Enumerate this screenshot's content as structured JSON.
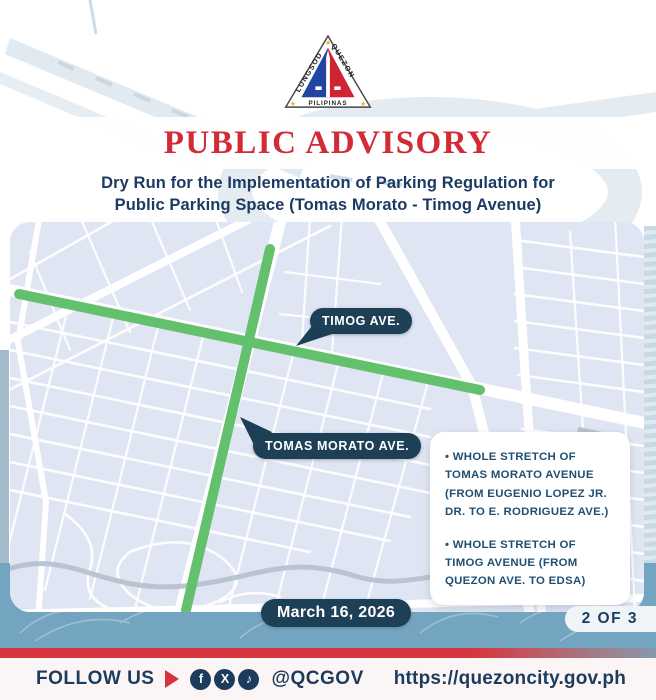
{
  "logo": {
    "lungsod": "LUNGSOD",
    "quezon": "QUEZON",
    "pilipinas": "PILIPINAS"
  },
  "header": {
    "title": "PUBLIC ADVISORY",
    "subtitle_line1": "Dry Run for the Implementation of Parking Regulation for",
    "subtitle_line2": "Public Parking Space (Tomas Morato - Timog Avenue)"
  },
  "map": {
    "label_timog": "TIMOG AVE.",
    "label_tomas_morato": "TOMAS MORATO AVE.",
    "info_items": [
      "• WHOLE STRETCH OF TOMAS MORATO AVENUE (FROM EUGENIO LOPEZ JR. DR. TO E. RODRIGUEZ AVE.)",
      "• WHOLE STRETCH OF TIMOG AVENUE (FROM QUEZON AVE. TO EDSA)"
    ],
    "date_badge": "March 16, 2026"
  },
  "pagination": "2 OF 3",
  "footer": {
    "follow_label": "FOLLOW US",
    "handle": "@QCGOV",
    "url": "https://quezoncity.gov.ph",
    "icons": [
      {
        "name": "facebook",
        "glyph": "f"
      },
      {
        "name": "x",
        "glyph": "X"
      },
      {
        "name": "tiktok",
        "glyph": "♪"
      }
    ]
  },
  "colors": {
    "advisory_red": "#d22b36",
    "navy_text": "#1c3b63",
    "pill_navy": "#1e4057",
    "map_green": "#63c06d",
    "map_bg": "#dfe5f2",
    "band_blue": "#74a5c0",
    "stripe_red": "#d8363e",
    "footer_bg": "#fcf5f5"
  }
}
